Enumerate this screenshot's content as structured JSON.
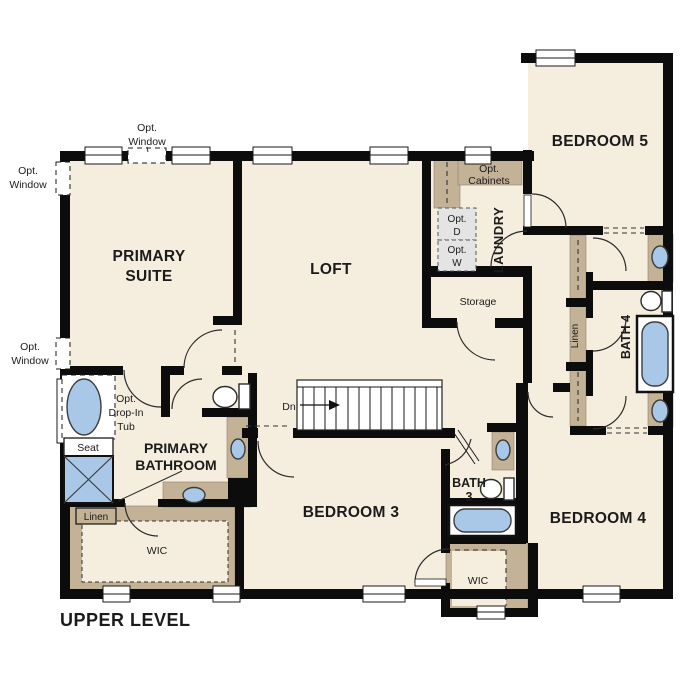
{
  "plan": {
    "title": "UPPER LEVEL",
    "labels": {
      "upper_level": "UPPER LEVEL",
      "primary_suite_l1": "PRIMARY",
      "primary_suite_l2": "SUITE",
      "loft": "LOFT",
      "bedroom_5": "BEDROOM 5",
      "bedroom_3": "BEDROOM 3",
      "bedroom_4": "BEDROOM 4",
      "primary_bathroom_l1": "PRIMARY",
      "primary_bathroom_l2": "BATHROOM",
      "bath_3_l1": "BATH",
      "bath_3_l2": "3",
      "bath_4": "BATH 4",
      "laundry": "LAUNDRY",
      "storage": "Storage",
      "wic_primary": "WIC",
      "wic_secondary": "WIC",
      "linen_primary": "Linen",
      "linen_hall": "Linen",
      "seat": "Seat",
      "stairs_dn": "Dn",
      "opt_window_l1": "Opt.",
      "opt_window_l2": "Window",
      "opt_cabinets_l1": "Opt.",
      "opt_cabinets_l2": "Cabinets",
      "opt_dryer_l1": "Opt.",
      "opt_dryer_l2": "D",
      "opt_washer_l1": "Opt.",
      "opt_washer_l2": "W",
      "opt_tub_l1": "Opt.",
      "opt_tub_l2": "Drop-In",
      "opt_tub_l3": "Tub"
    },
    "colors": {
      "background": "#ffffff",
      "floor": "#f5eedf",
      "cabinet_tan": "#c3b296",
      "fixture_blue": "#a9c8e8",
      "appliance_gray": "#e4e4e4",
      "wall": "#0c0c0c"
    }
  }
}
